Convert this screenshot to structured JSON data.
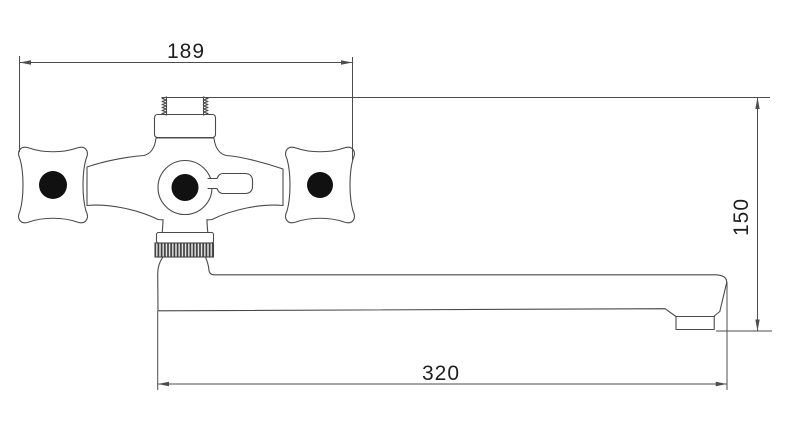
{
  "drawing": {
    "subject": "wall-mounted bathtub faucet with two cross handles, central diverter lever and long swivel spout, front elevation technical drawing",
    "background_color": "#ffffff",
    "line_color": "#4a4a4a",
    "dimension_line_color": "#4d4d4d",
    "label_color": "#1f1f1f",
    "handle_dot_color": "#111111",
    "knurl_stripe_color": "#3f3f3f"
  },
  "dimensions": {
    "top_width": "189",
    "right_height": "150",
    "bottom_length": "320"
  }
}
